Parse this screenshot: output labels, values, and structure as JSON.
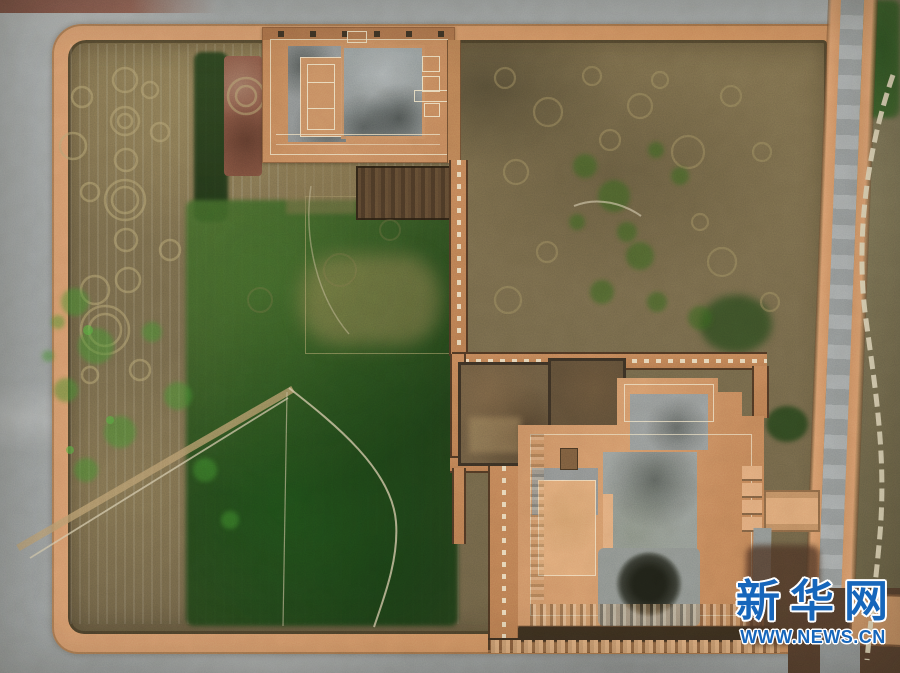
{
  "watermark": {
    "brand": "新华网",
    "site": "WWW.NEWS.CN",
    "brand_color": "#1666bb",
    "outline_color": "#ffffff"
  },
  "palette": {
    "roadGrey": "#9ca1a3",
    "wallTan": "#d89a6d",
    "fieldOlive": "#7b6d4d",
    "greenDark": "#27471f",
    "greenBright": "#49a13a",
    "platformTan": "#cb8f64",
    "stoneGrey": "#9aa09f",
    "debrisRed": "#8a5a49",
    "pathLight": "#ddd3b6",
    "wmBlue": "#1666bb"
  }
}
